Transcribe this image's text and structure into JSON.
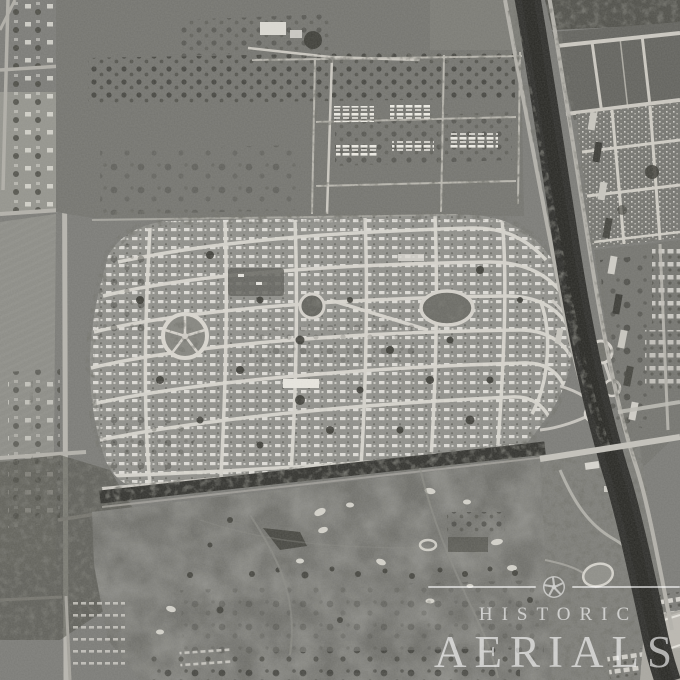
{
  "watermark": {
    "brand_top": "HISTORIC",
    "brand_bottom": "AERIALS",
    "logo_icon": "aperture-camera-icon",
    "text_color": "#ffffff"
  },
  "photo": {
    "description": "Black-and-white historic aerial photograph: an oval planned residential subdivision with a circular park and small round greens, bounded by tree-lined roads and a dark canal with barges; orchards, nursery plots and an estate to the north; fields and a cemetery grid east of the canal; a golf course with sand bunkers and a wooded suburb with a pond to the south.",
    "tones": {
      "field": "#74746f",
      "housing": "#8f8f8a",
      "water": "#2d2d2a",
      "streets": "#dad7d0",
      "trees": "#30302c",
      "golf": "#6f6f6a"
    }
  }
}
